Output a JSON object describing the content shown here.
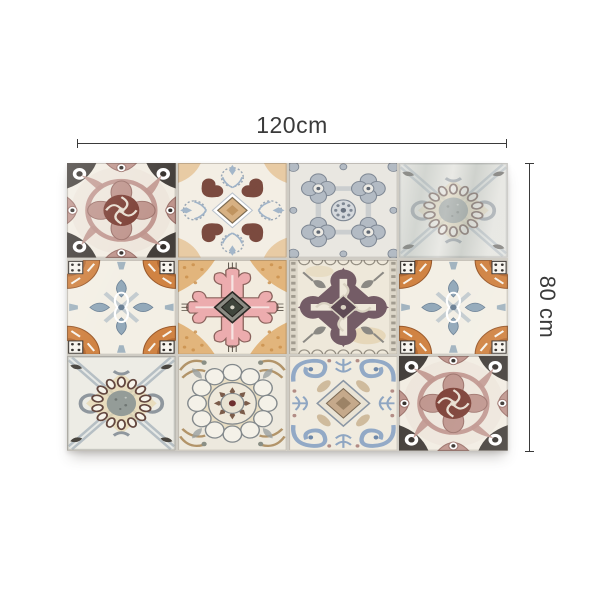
{
  "page": {
    "background": "#ffffff"
  },
  "dimensions": {
    "width_label": "120cm",
    "height_label": "80 cm",
    "line_color": "#3a3a3a"
  },
  "product": {
    "grid": {
      "rows": 3,
      "cols": 4
    },
    "tiles": [
      [
        "rosette",
        "floral_hearts",
        "quatrefoil",
        "bead_ring"
      ],
      [
        "fan_cross",
        "pink_baroque",
        "purple_damask",
        "fan_cross"
      ],
      [
        "bead_ring",
        "mandala",
        "blue_scroll",
        "rosette"
      ]
    ],
    "glare_cells": [
      [
        0,
        3
      ]
    ],
    "palette": {
      "cream": "#f2ede3",
      "cream2": "#e9e7e1",
      "grout": "#cfccc4",
      "black": "#35302c",
      "mauve": "#bf958d",
      "mauve_dark": "#9c726b",
      "maroon": "#7c3f35",
      "brown": "#7b4a3f",
      "tan": "#d7b183",
      "tan_light": "#e7d7ae",
      "gold": "#dda763",
      "orange": "#d08343",
      "orange_dark": "#9a5a2c",
      "pink": "#ecacae",
      "pink_dark": "#8a625c",
      "bluegray": "#93a9ba",
      "slate": "#8a96a4",
      "blue": "#92a9c6",
      "steel": "#8f979e",
      "plum": "#745c66",
      "plum_dark": "#5e4a54",
      "olive": "#3f453c",
      "gray": "#83898c",
      "bead": "#63473f"
    }
  }
}
